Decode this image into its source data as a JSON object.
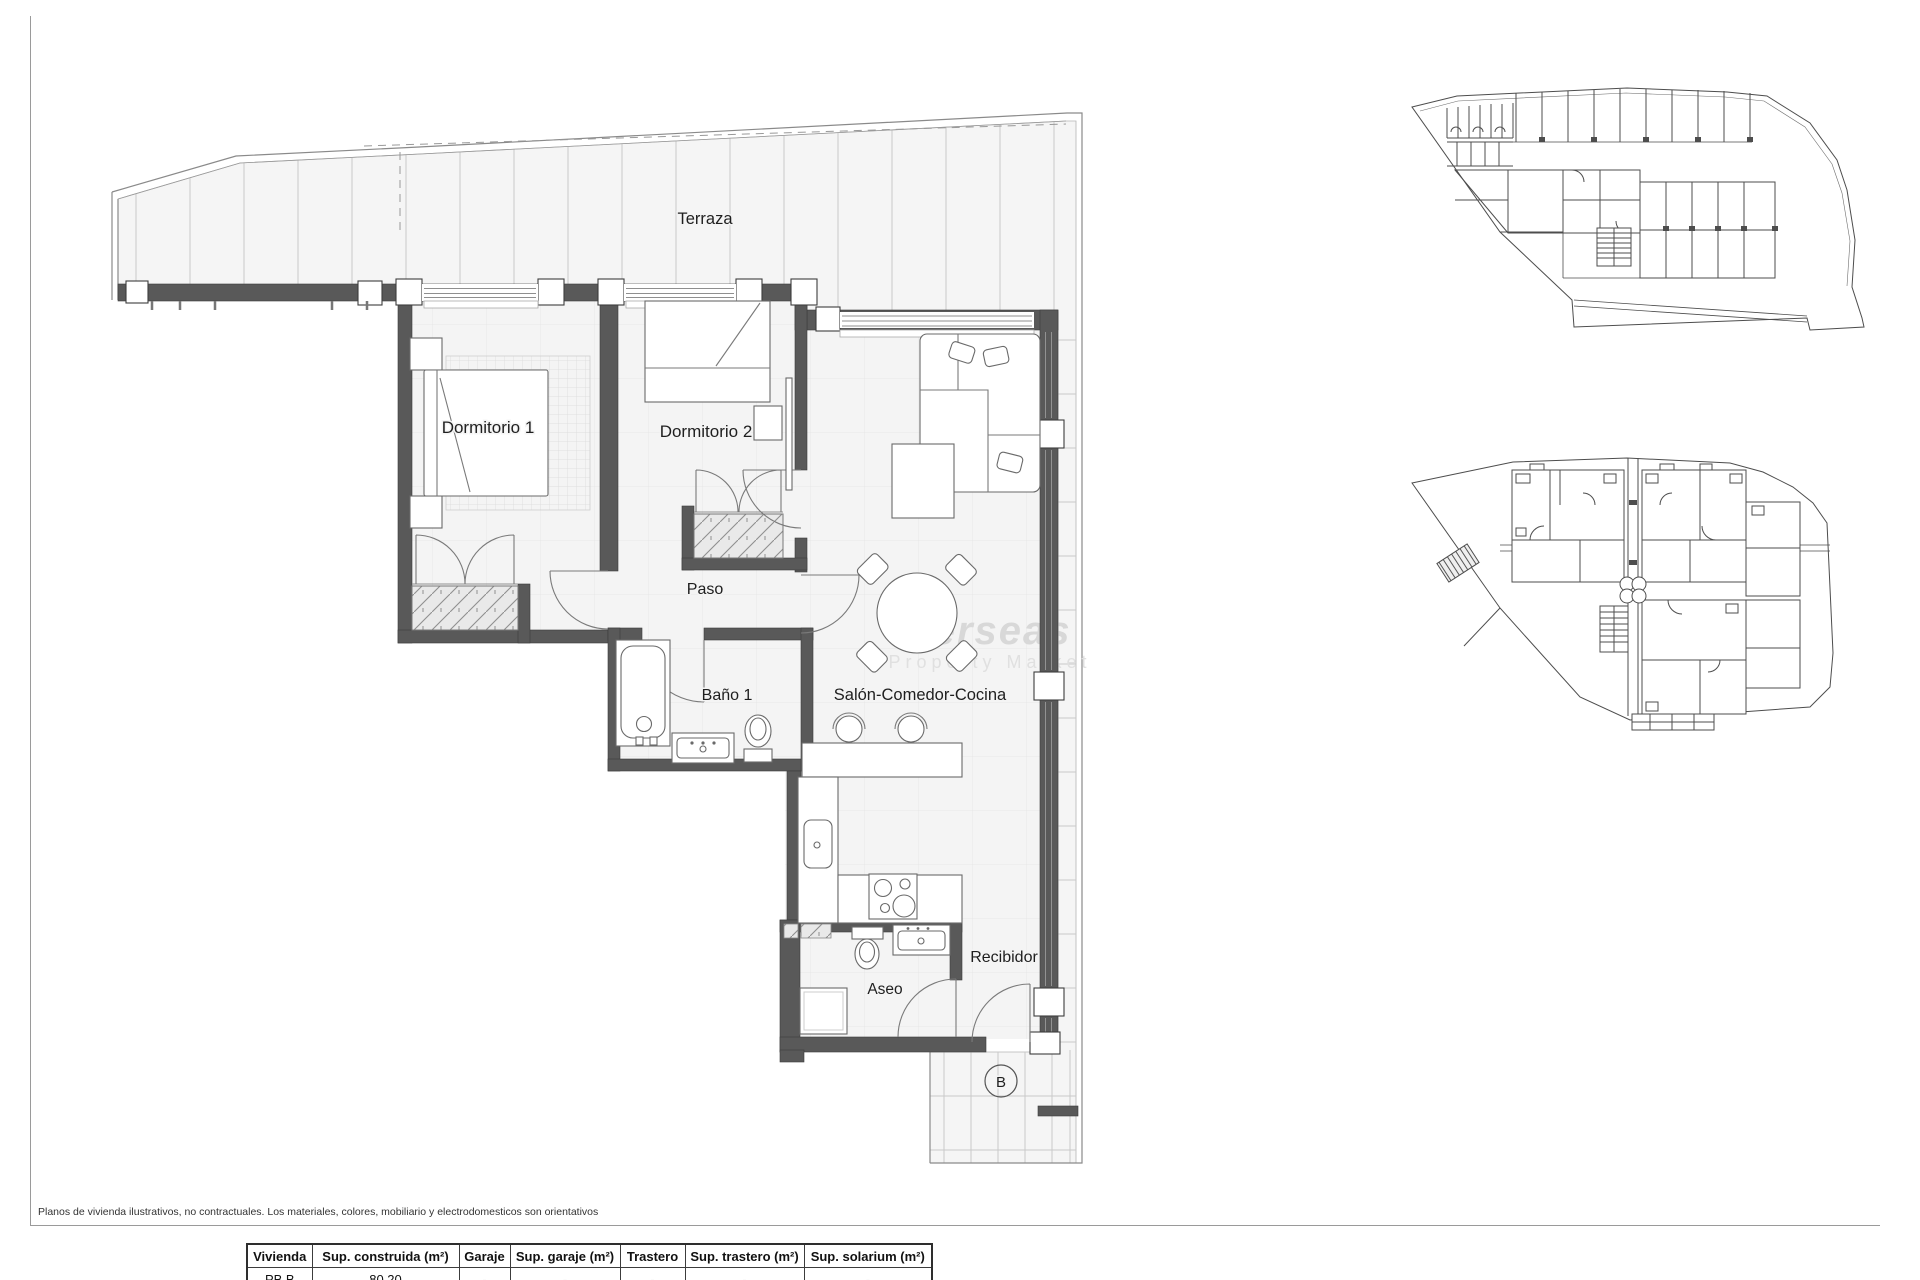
{
  "plan_labels": {
    "terraza": "Terraza",
    "dormitorio1": "Dormitorio 1",
    "dormitorio2": "Dormitorio 2",
    "paso": "Paso",
    "bano1": "Baño 1",
    "salon": "Salón-Comedor-Cocina",
    "aseo": "Aseo",
    "recibidor": "Recibidor",
    "unit": "B"
  },
  "watermark": {
    "line1": "verseas",
    "line2": "Property Market"
  },
  "footer": {
    "disclaimer": "Planos de vivienda ilustrativos, no contractuales. Los materiales, colores, mobiliario y electrodomesticos son orientativos"
  },
  "table": {
    "headers": [
      "Vivienda",
      "Sup. construida (m²)",
      "Garaje",
      "Sup. garaje (m²)",
      "Trastero",
      "Sup. trastero (m²)",
      "Sup. solarium (m²)"
    ],
    "rows": [
      [
        "PB B",
        "80.20",
        "-",
        "-",
        "-",
        "-",
        "-"
      ]
    ]
  },
  "colors": {
    "wall": "#595959",
    "floor": "#f4f4f4",
    "floor_grid": "#e7e7e7",
    "tile_line": "#c9c9c9",
    "line": "#6a6a6a",
    "label": "#1f1f1f",
    "watermark": "#d8d8d8"
  }
}
